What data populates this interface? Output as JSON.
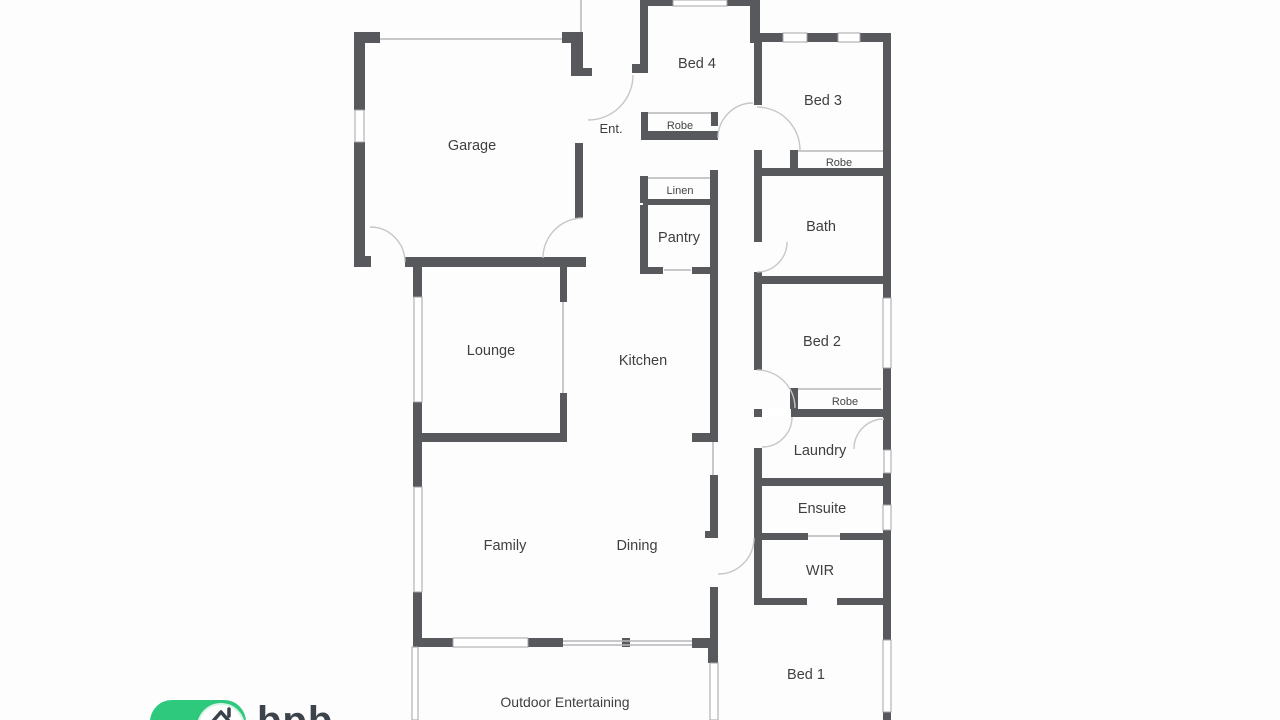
{
  "colors": {
    "background": "#fdfdfd",
    "wall": "#58595c",
    "thin_line": "#b6b7b9",
    "door_arc": "#c6c7c9",
    "label_text": "#3e3f41",
    "logo_green": "#2fc97e",
    "logo_text_color": "#3d434b"
  },
  "rooms": {
    "garage": {
      "label": "Garage"
    },
    "entry": {
      "label": "Ent."
    },
    "bed4": {
      "label": "Bed 4"
    },
    "robe_bed4": {
      "label": "Robe"
    },
    "bed3": {
      "label": "Bed 3"
    },
    "robe_bed3": {
      "label": "Robe"
    },
    "linen": {
      "label": "Linen"
    },
    "pantry": {
      "label": "Pantry"
    },
    "bath": {
      "label": "Bath"
    },
    "lounge": {
      "label": "Lounge"
    },
    "kitchen": {
      "label": "Kitchen"
    },
    "bed2": {
      "label": "Bed 2"
    },
    "robe_bed2": {
      "label": "Robe"
    },
    "laundry": {
      "label": "Laundry"
    },
    "ensuite": {
      "label": "Ensuite"
    },
    "wir": {
      "label": "WIR"
    },
    "family": {
      "label": "Family"
    },
    "dining": {
      "label": "Dining"
    },
    "bed1": {
      "label": "Bed 1"
    },
    "outdoor": {
      "label": "Outdoor Entertaining"
    }
  },
  "logo": {
    "text": "bpb",
    "icon": "house-roof-icon"
  }
}
